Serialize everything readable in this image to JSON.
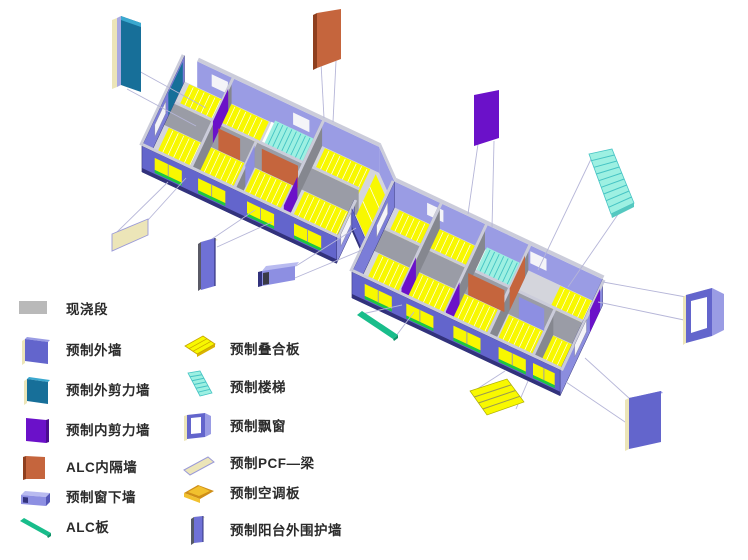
{
  "diagram": {
    "type": "prefabricated-building-exploded-axonometric",
    "description_visible_text_only": true
  },
  "colors": {
    "text": "#2b2b2b",
    "leader": "#b6b6d8",
    "cast_gray": "#b9b9b9",
    "ext_wall": "#6365cc",
    "ext_wall_mid": "#7b7dd8",
    "ext_wall_light": "#9a9ce4",
    "ext_wall_light2": "#8b8dde",
    "navy": "#32327c",
    "wall_gray": "#9a9ca6",
    "wall_gray_dark": "#85878f",
    "wall_cap": "#cbccda",
    "floor_gray": "#d4d5dc",
    "slab_yellow": "#f8f800",
    "slab_stripe": "#ffffff",
    "green_strip": "#1dc83e",
    "stairs_cyan": "#9df0e2",
    "stairs_edge": "#46c4c4",
    "shear_int": "#6b11c9",
    "shear_ext": "#176f99",
    "shear_ext_light": "#3aa8cf",
    "alc_orange": "#c5653d",
    "alc_orange_dark": "#8f3f1e",
    "sill_wall": "#8d8fe2",
    "sill_wall_light": "#b9bbf0",
    "alc_green": "#19bd8b",
    "alc_green_dark": "#0f9268",
    "pcf_cream": "#ece5b8",
    "ac_gold": "#f2c12e",
    "ac_gold_dark": "#cf8f18",
    "balcony_wall": "#6f71d6",
    "window_white": "#f4f4f8"
  },
  "legend": {
    "col1": [
      {
        "id": "cast-segment",
        "label": "现浇段"
      },
      {
        "id": "precast-exterior-wall",
        "label": "预制外墙"
      },
      {
        "id": "precast-exterior-shear-wall",
        "label": "预制外剪力墙"
      },
      {
        "id": "precast-interior-shear-wall",
        "label": "预制内剪力墙"
      },
      {
        "id": "alc-partition",
        "label": "ALC内隔墙"
      },
      {
        "id": "precast-window-sill-wall",
        "label": "预制窗下墙"
      },
      {
        "id": "alc-panel",
        "label": "ALC板"
      }
    ],
    "col2": [
      {
        "id": "precast-composite-slab",
        "label": "预制叠合板"
      },
      {
        "id": "precast-stair",
        "label": "预制楼梯"
      },
      {
        "id": "precast-bay-window",
        "label": "预制飘窗"
      },
      {
        "id": "precast-pcf-beam",
        "label": "预制PCF—梁"
      },
      {
        "id": "precast-ac-slab",
        "label": "预制空调板"
      },
      {
        "id": "precast-balcony-enclosure-wall",
        "label": "预制阳台外围护墙"
      }
    ]
  },
  "components_shown_exploded": [
    "precast-exterior-shear-wall",
    "alc-partition",
    "precast-interior-shear-wall",
    "precast-stair",
    "precast-bay-window",
    "precast-exterior-wall",
    "precast-composite-slab",
    "alc-panel",
    "precast-window-sill-wall",
    "precast-balcony-enclosure-wall",
    "precast-pcf-beam"
  ]
}
